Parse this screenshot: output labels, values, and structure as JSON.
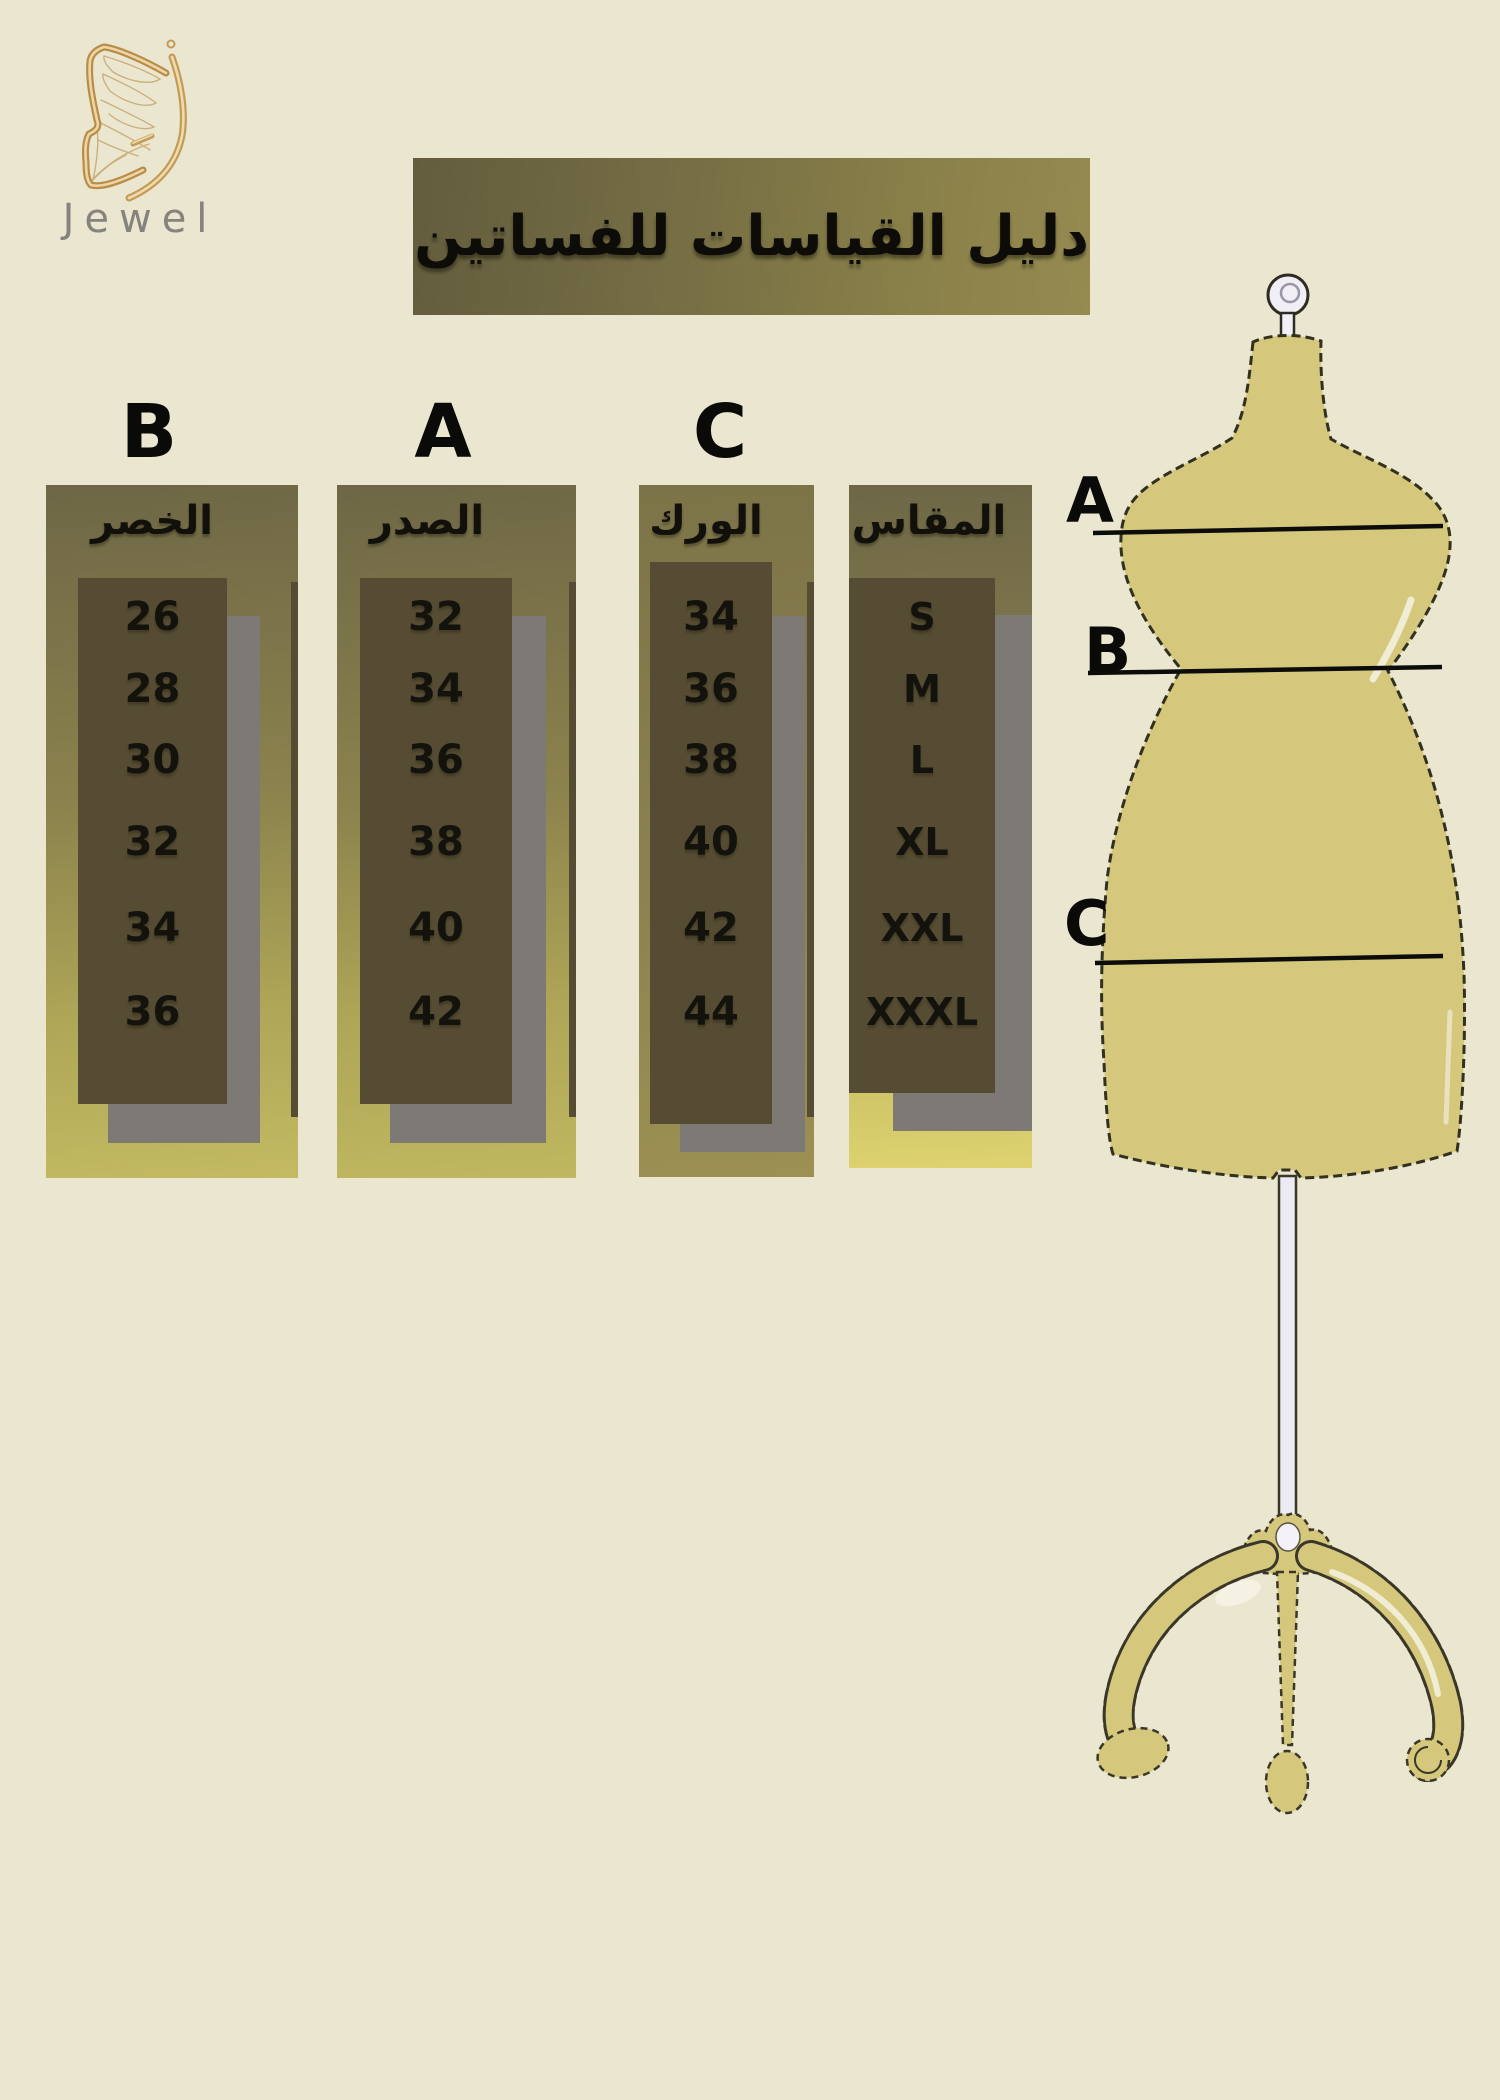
{
  "brand": {
    "name": "Jewel"
  },
  "title": {
    "text": "دليل القياسات للفساتين"
  },
  "size_chart": {
    "columns": [
      {
        "letter": "B",
        "header": "الخصر",
        "values": [
          "26",
          "28",
          "30",
          "32",
          "34",
          "36"
        ]
      },
      {
        "letter": "A",
        "header": "الصدر",
        "values": [
          "32",
          "34",
          "36",
          "38",
          "40",
          "42"
        ]
      },
      {
        "letter": "C",
        "header": "الورك",
        "values": [
          "34",
          "36",
          "38",
          "40",
          "42",
          "44"
        ]
      },
      {
        "letter": "",
        "header": "المقاس",
        "values": [
          "S",
          "M",
          "L",
          "XL",
          "XXL",
          "XXXL"
        ]
      }
    ]
  },
  "mannequin": {
    "labels": [
      "A",
      "B",
      "C"
    ]
  },
  "colors": {
    "background": "#ebe6d0",
    "banner_dark": "#645d3d",
    "banner_light": "#958b51",
    "panel_top": "#6e6746",
    "panel_bottom_yellow": "#c3ba62",
    "value_box": "#564c33",
    "shadow_gray": "#7d7a76",
    "text_black": "#12100a",
    "logo_gold": "#c9a25f",
    "brand_gray": "#84837d",
    "mannequin_fill": "#d5c87c"
  }
}
